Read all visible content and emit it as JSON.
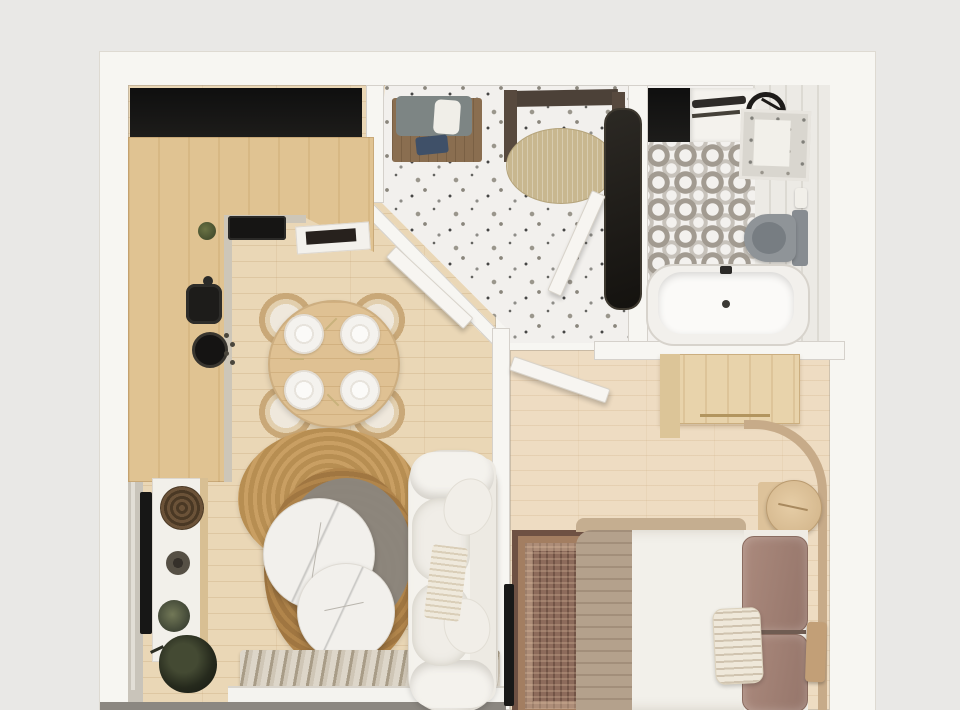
{
  "scene": {
    "type": "3d-floor-plan-render",
    "name": "one-bedroom-apartment-top-view",
    "rooms": [
      {
        "name": "kitchen-living-room",
        "furniture": [
          "l-shaped-wood-counter",
          "dark-upper-niche",
          "cooktop",
          "black-sink",
          "stove-burner",
          "round-dining-table",
          "dining-chair",
          "place-setting",
          "light-jute-rug",
          "dark-jute-rug",
          "round-marble-coffee-table",
          "white-curved-sofa",
          "throw-blanket",
          "tv-console",
          "wall-mounted-tv",
          "woven-basket",
          "decor-bowl",
          "potted-plant",
          "radiator",
          "window-sill"
        ]
      },
      {
        "name": "entry-hall",
        "furniture": [
          "entry-door-frame",
          "oval-doormat",
          "shoe-bench",
          "bench-cushion",
          "floor-mirror",
          "terrazzo-floor",
          "open-door"
        ]
      },
      {
        "name": "bathroom",
        "furniture": [
          "dark-niche",
          "vanity-counter",
          "towel-rack",
          "black-faucet",
          "laundry-box",
          "toilet",
          "bathtub",
          "patterned-tile-floor",
          "marble-strip"
        ]
      },
      {
        "name": "bedroom",
        "furniture": [
          "wardrobe",
          "open-door",
          "double-bed",
          "duvet",
          "taupe-throw",
          "brown-pillow",
          "striped-pillow",
          "curved-headboard",
          "round-nightstand",
          "persian-rug",
          "wall-art",
          "wall-mounted-tv"
        ]
      }
    ]
  },
  "palette": {
    "bg": "#e9e8e6",
    "wall": "#f7f6f2",
    "niche": "#1d1c1a",
    "wood-floor": "#ead7b6",
    "wood-floor-bed": "#eedcc2",
    "wood-counter": "#e0c392",
    "terrazzo": "#f2f0ed",
    "tile-grey": "#a29b91",
    "marble": "#eceae5",
    "jute-light": "#c99f63",
    "jute-dark": "#b1854b",
    "sofa": "#f4f2ed",
    "pillow-brown": "#95756a",
    "blanket-taupe": "#b4a18c",
    "headboard": "#c7ab89",
    "rug-persian": "#8d6b5b",
    "rug-persian-dark": "#6e5143",
    "wardrobe": "#e8d3ab",
    "toilet-grey": "#8f9498",
    "radiator-dark": "#a89c87",
    "door-frame": "#4c4138",
    "doormat": "#c8b78f",
    "bench-wood": "#8a6e50",
    "tv-black": "#171716"
  }
}
